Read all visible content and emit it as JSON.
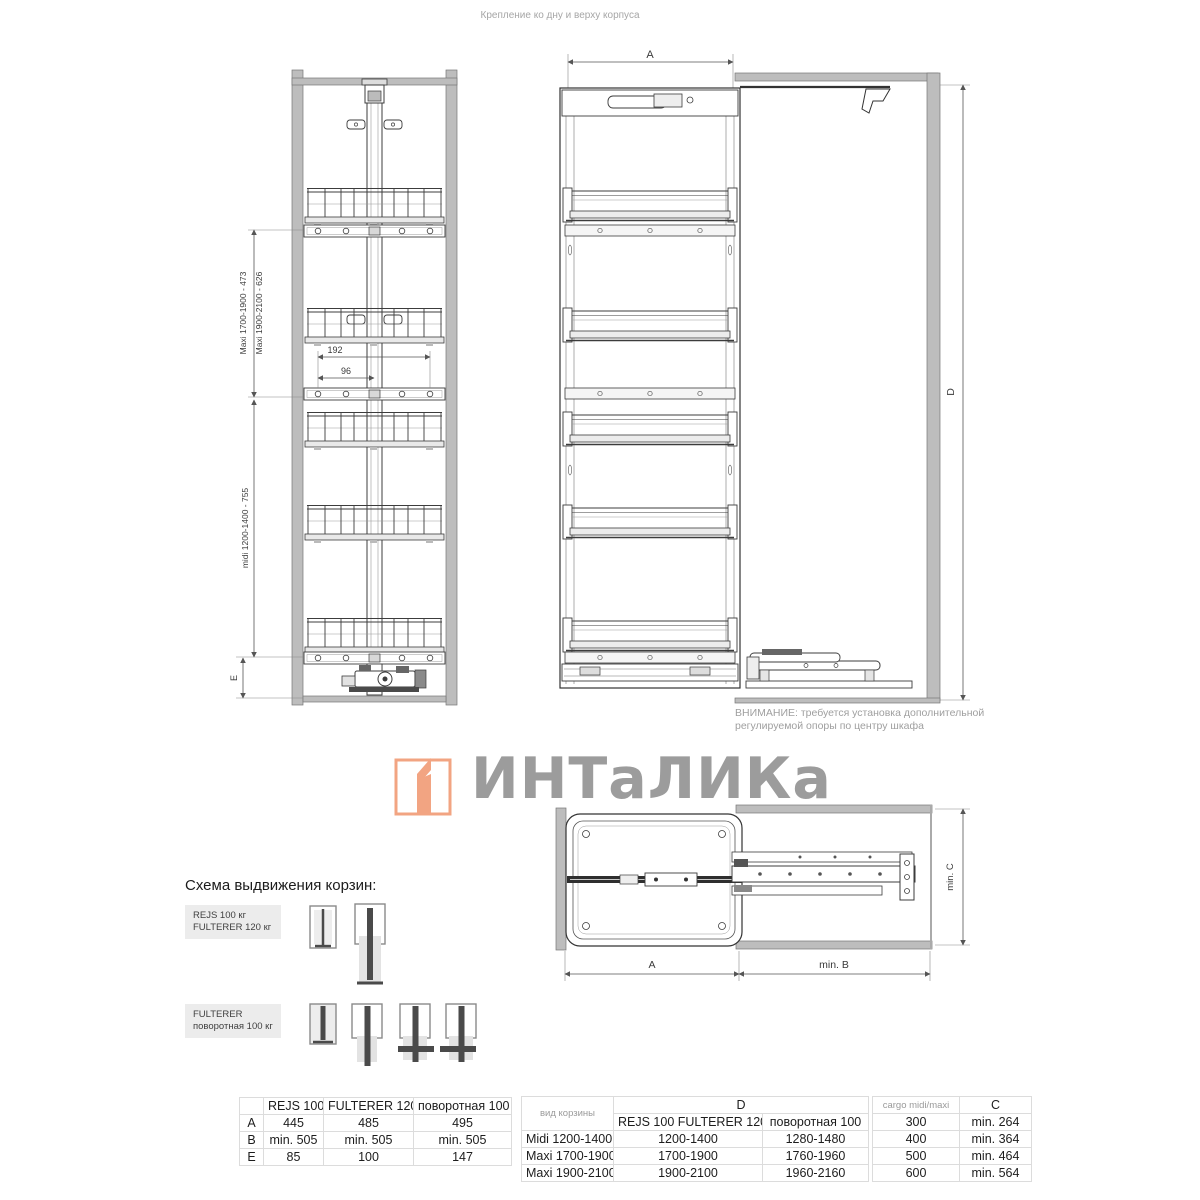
{
  "page": {
    "caption_top": "Крепление ко дну и верху корпуса"
  },
  "front_view": {
    "dim_maxi_1700": "Maxi 1700-1900 - 473",
    "dim_maxi_1900": "Maxi 1900-2100 - 626",
    "dim_midi": "midi 1200-1400 - 755",
    "dim_e_label": "E",
    "dim_192": "192",
    "dim_96": "96"
  },
  "side_view": {
    "dim_a": "A",
    "dim_d": "D"
  },
  "warning": {
    "line1": "ВНИМАНИЕ: требуется установка дополнительной",
    "line2": "регулируемой опоры по центру шкафа"
  },
  "logo": {
    "text": "ИНТаЛИКа"
  },
  "top_view": {
    "dim_a": "A",
    "dim_min_b": "min. B",
    "dim_min_c": "min. C"
  },
  "schema": {
    "heading": "Схема выдвижения корзин:",
    "row1": {
      "label_line1": "REJS 100 кг",
      "label_line2": "FULTERER 120 кг"
    },
    "row2": {
      "label_line1": "FULTERER",
      "label_line2": "поворотная 100 кг"
    }
  },
  "table_abe": {
    "col_headers": [
      "REJS 100",
      "FULTERER 120",
      "поворотная 100"
    ],
    "rows": [
      {
        "label": "A",
        "v1": "445",
        "v2": "485",
        "v3": "495"
      },
      {
        "label": "B",
        "v1": "min. 505",
        "v2": "min. 505",
        "v3": "min. 505"
      },
      {
        "label": "E",
        "v1": "85",
        "v2": "100",
        "v3": "147"
      }
    ]
  },
  "table_d": {
    "col1_header": "вид корзины",
    "group_header": "D",
    "sub_header_1": "REJS 100  FULTERER 120",
    "sub_header_2": "поворотная 100",
    "rows": [
      {
        "label": "Midi 1200-1400",
        "v1": "1200-1400",
        "v2": "1280-1480"
      },
      {
        "label": "Maxi 1700-1900",
        "v1": "1700-1900",
        "v2": "1760-1960"
      },
      {
        "label": "Maxi 1900-2100",
        "v1": "1900-2100",
        "v2": "1960-2160"
      }
    ]
  },
  "table_c": {
    "col1_header": "cargo midi/maxi",
    "col2_header": "C",
    "rows": [
      {
        "cargo": "300",
        "c": "min. 264"
      },
      {
        "cargo": "400",
        "c": "min. 364"
      },
      {
        "cargo": "500",
        "c": "min. 464"
      },
      {
        "cargo": "600",
        "c": "min. 564"
      }
    ]
  },
  "colors": {
    "accent_orange": "#F2A482",
    "logo_gray": "#9C9C9C",
    "wall_gray": "#BDBDBD",
    "line_dark": "#3C3C3C"
  }
}
